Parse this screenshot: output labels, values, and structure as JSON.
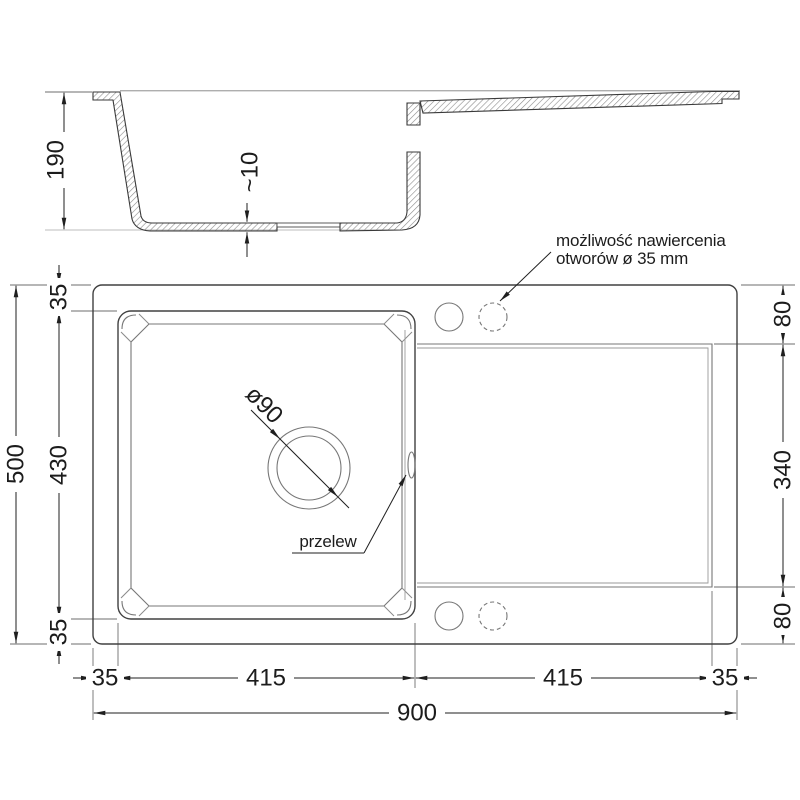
{
  "section": {
    "height": "190",
    "bottom_thickness": "~10"
  },
  "plan": {
    "overall_width": "900",
    "overall_depth": "500",
    "left_chain": {
      "top": "35",
      "middle": "430",
      "bottom": "35"
    },
    "right_chain": {
      "top": "80",
      "middle": "340",
      "bottom": "80"
    },
    "bottom_chain": {
      "left_margin": "35",
      "bowl_width": "415",
      "drainer_width": "415",
      "right_margin": "35"
    },
    "drain_diameter": "ø90",
    "overflow_label": "przelew",
    "drill_note": {
      "line1": "możliwość nawiercenia",
      "line2": "otworów ø 35 mm"
    }
  }
}
